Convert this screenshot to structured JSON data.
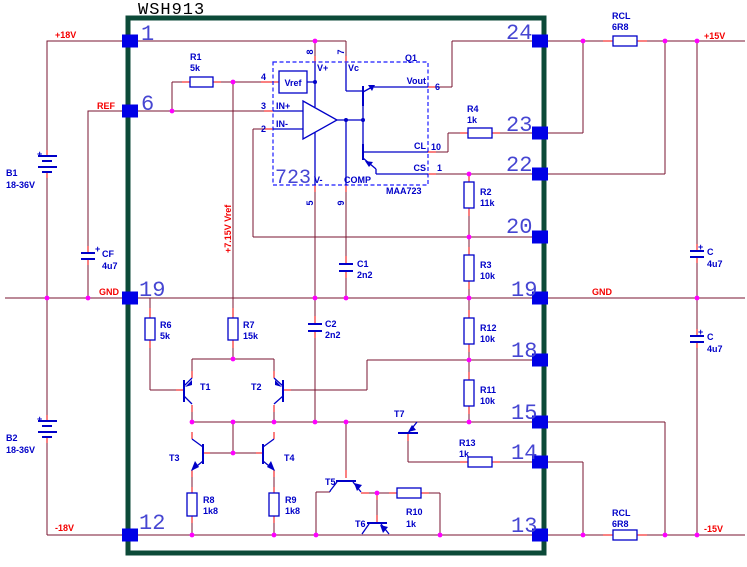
{
  "title": "WSH913",
  "nets": {
    "plus18": "+18V",
    "ref": "REF",
    "gnd_left": "GND",
    "minus18": "-18V",
    "plus15": "+15V",
    "gnd_right": "GND",
    "minus15": "-15V",
    "vref_rail": "+7.15V Vref"
  },
  "pins": {
    "left": {
      "p1": "1",
      "p6": "6",
      "p19": "19",
      "p12": "12"
    },
    "right": {
      "p24": "24",
      "p23": "23",
      "p22": "22",
      "p20": "20",
      "p19": "19",
      "p18": "18",
      "p15": "15",
      "p14": "14",
      "p13": "13"
    }
  },
  "ic": {
    "big": "723",
    "part": "MAA723",
    "q1": "Q1",
    "vref_block": "Vref",
    "pads": {
      "vplus": {
        "label": "V+",
        "num": "8"
      },
      "vc": {
        "label": "Vc",
        "num": "7"
      },
      "ref": {
        "num": "4"
      },
      "inp": {
        "label": "IN+",
        "num": "3"
      },
      "inn": {
        "label": "IN-",
        "num": "2"
      },
      "vout": {
        "label": "Vout",
        "num": "6"
      },
      "cl": {
        "label": "CL",
        "num": "10"
      },
      "cs": {
        "label": "CS",
        "num": "1"
      },
      "vminus": {
        "label": "V-",
        "num": "5"
      },
      "comp": {
        "label": "COMP",
        "num": "9"
      }
    }
  },
  "resistors": {
    "r1": {
      "name": "R1",
      "value": "5k"
    },
    "r2": {
      "name": "R2",
      "value": "11k"
    },
    "r3": {
      "name": "R3",
      "value": "10k"
    },
    "r4": {
      "name": "R4",
      "value": "1k"
    },
    "r6": {
      "name": "R6",
      "value": "5k"
    },
    "r7": {
      "name": "R7",
      "value": "15k"
    },
    "r8": {
      "name": "R8",
      "value": "1k8"
    },
    "r9": {
      "name": "R9",
      "value": "1k8"
    },
    "r10": {
      "name": "R10",
      "value": "1k"
    },
    "r11": {
      "name": "R11",
      "value": "10k"
    },
    "r12": {
      "name": "R12",
      "value": "10k"
    },
    "r13": {
      "name": "R13",
      "value": "1k"
    },
    "rcl_top": {
      "name": "RCL",
      "value": "6R8"
    },
    "rcl_bottom": {
      "name": "RCL",
      "value": "6R8"
    }
  },
  "capacitors": {
    "c1": {
      "name": "C1",
      "value": "2n2"
    },
    "c2": {
      "name": "C2",
      "value": "2n2"
    },
    "cf": {
      "name": "CF",
      "value": "4u7",
      "polarity": "+"
    },
    "c_top": {
      "name": "C",
      "value": "4u7",
      "polarity": "+"
    },
    "c_bottom": {
      "name": "C",
      "value": "4u7",
      "polarity": "+"
    }
  },
  "batteries": {
    "b1": {
      "name": "B1",
      "value": "18-36V",
      "polarity": "+"
    },
    "b2": {
      "name": "B2",
      "value": "18-36V",
      "polarity": "+"
    }
  },
  "transistors": {
    "t1": "T1",
    "t2": "T2",
    "t3": "T3",
    "t4": "T4",
    "t5": "T5",
    "t6": "T6",
    "t7": "T7"
  },
  "colors": {
    "wire": "#7a1430",
    "lead": "#f40000",
    "symbol": "#0000c8",
    "pad": "#0000e6",
    "pin_number": "#4646d2",
    "junction": "#ff00ff",
    "module_border": "#0c4a38",
    "net_label": "#f40000",
    "background": "#ffffff"
  }
}
